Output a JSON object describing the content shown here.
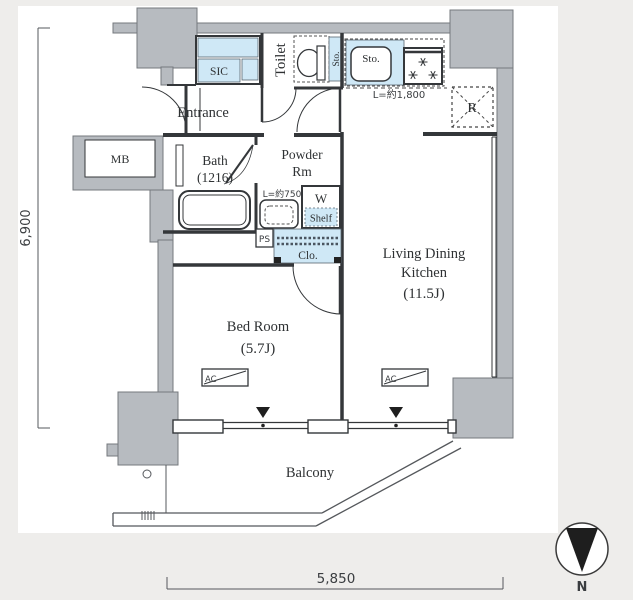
{
  "rooms": {
    "entrance": {
      "label": "Entrance"
    },
    "sic": {
      "label": "SIC"
    },
    "toilet": {
      "label": "Toilet"
    },
    "toilet_storage": {
      "label": "Sto."
    },
    "bath": {
      "label": "Bath",
      "size": "(1216)"
    },
    "powder_room": {
      "label_line1": "Powder",
      "label_line2": "Rm"
    },
    "meter_box": {
      "label": "MB"
    },
    "kitchen_storage": {
      "label": "Sto."
    },
    "refrigerator_space": {
      "label": "R"
    },
    "washer": {
      "label": "W"
    },
    "shelf": {
      "label": "Shelf"
    },
    "pipe_space": {
      "label": "PS"
    },
    "closet": {
      "label": "Clo."
    },
    "living_dining_kitchen": {
      "label_line1": "Living Dining",
      "label_line2": "Kitchen",
      "size": "(11.5J)"
    },
    "bedroom": {
      "label": "Bed Room",
      "size": "(5.7J)"
    },
    "balcony": {
      "label": "Balcony"
    },
    "ac_bedroom": {
      "label": "AC"
    },
    "ac_ldk": {
      "label": "AC"
    }
  },
  "annotations": {
    "kitchen_counter_length": "L=約1,800",
    "vanity_length": "L=約750"
  },
  "dimensions": {
    "vertical": "6,900",
    "horizontal": "5,850"
  },
  "compass": {
    "north_label": "N"
  },
  "colors": {
    "background": "#eeedeb",
    "floor_white": "#ffffff",
    "wall_gray": "#b7bbc0",
    "wall_gray_stroke": "#74787e",
    "fixture_blue": "#cfe8f6",
    "line_dark": "#34373a"
  }
}
